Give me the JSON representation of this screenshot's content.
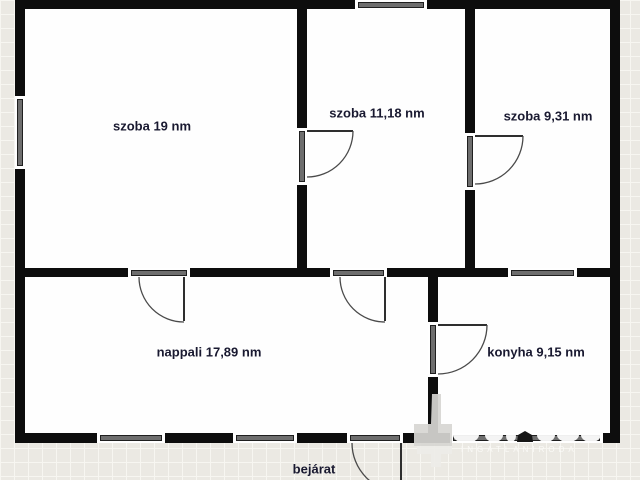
{
  "floorplan": {
    "room_labels": {
      "szoba1": "szoba 19 nm",
      "szoba2": "szoba 11,18 nm",
      "szoba3": "szoba 9,31 nm",
      "nappali": "nappali 17,89 nm",
      "konyha": "konyha 9,15 nm",
      "bejarat": "bejárat"
    },
    "watermark": {
      "agency_text": "INGATLANIRODA"
    },
    "colors": {
      "wall": "#0d0d0d",
      "label_text": "#191930",
      "opening_fill": "#6e6e6e",
      "background": "#ebe9e3",
      "floor": "#fefefe"
    }
  }
}
